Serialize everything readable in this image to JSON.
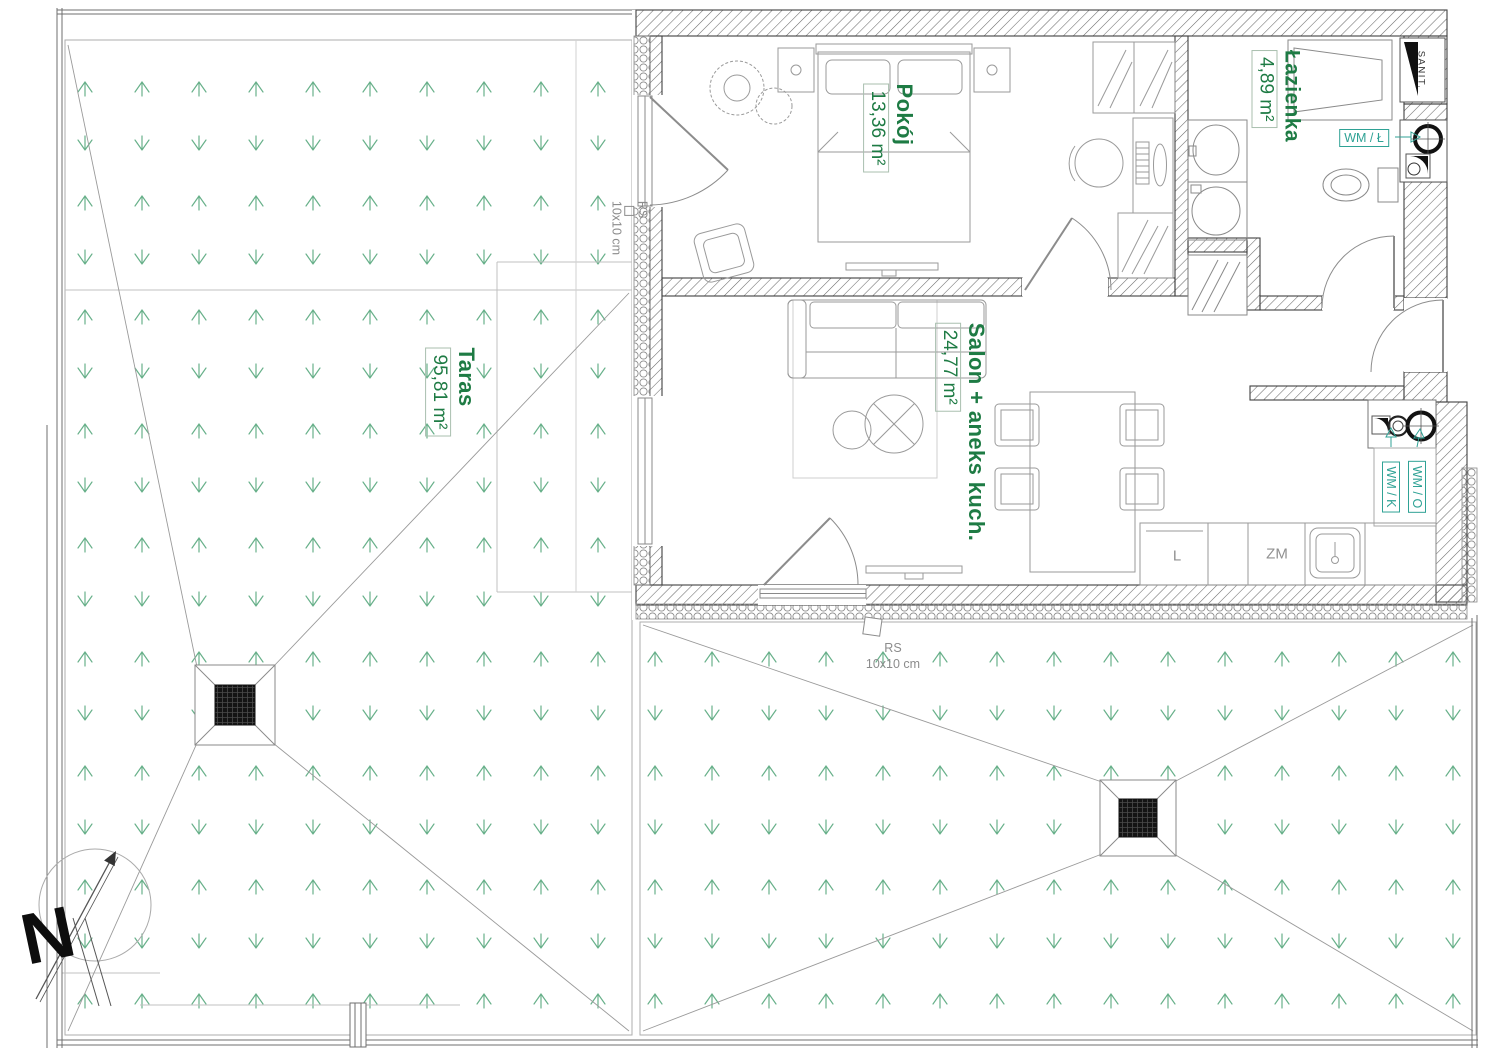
{
  "rooms": [
    {
      "name": "Pokój",
      "area": "13,36 m²"
    },
    {
      "name": "Łazienka",
      "area": "4,89 m²"
    },
    {
      "name": "Salon + aneks kuch.",
      "area": "24,77 m²"
    },
    {
      "name": "Taras",
      "area": "95,81 m²"
    }
  ],
  "vents": {
    "bathroom": "WM / Ł",
    "kitchen": "WM / K",
    "other": "WM / O"
  },
  "shaft": {
    "sanitary": "SANIT."
  },
  "kitchen": {
    "fridge": "L",
    "dishwasher": "ZM"
  },
  "drains": {
    "top": {
      "line1": "RS",
      "line2": "10x10 cm"
    },
    "bottom": {
      "line1": "RS",
      "line2": "10x10 cm"
    }
  },
  "compass": {
    "north": "N"
  },
  "colors": {
    "room_label": "#1e7b44",
    "vent_label": "#2fa295",
    "grass": "#57a87d",
    "wall_outline": "#414141",
    "annotation": "#8c8c8c"
  }
}
